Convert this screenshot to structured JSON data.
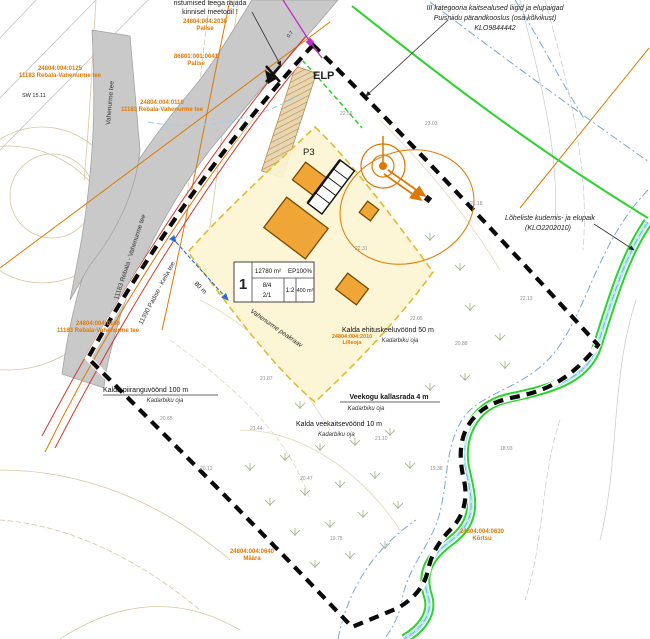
{
  "notes": {
    "crossing_line1": "ristumised teega rajada",
    "crossing_line2": "kinnisel meetodil !",
    "habitat_line1": "III kategooria kaitsealused liigid ja elupaigad",
    "habitat_line2": "Puisniidu pärandkooslus (osa kõlvikust)",
    "habitat_line3": "KLO9844442",
    "spawning_line1": "Lõheliste kudemis- ja elupaik",
    "spawning_line2": "(KLO2202010)"
  },
  "zones": {
    "piirang": {
      "label": "Kalda piiranguvöönd 100 m",
      "stream": "Kadarbiku oja"
    },
    "keeld": {
      "label": "Kalda ehituskeeluvöönd 50 m",
      "stream": "Kadarbiku oja"
    },
    "kallasrada": {
      "label": "Veekogu kallasrada 4 m",
      "stream": "Kadarbiku oja"
    },
    "veekaitse": {
      "label": "Kalda veekaitsevöönd 10 m",
      "stream": "Kadarbiku oja"
    }
  },
  "plot": {
    "number": "1",
    "area": "12780 m²",
    "coverage": "EP100%",
    "heights": "8/4",
    "floors": "2/1",
    "roof": "1:2",
    "building_area": "400 m²"
  },
  "labels": {
    "elp": "ELP",
    "parking": "P3",
    "ditch": "Vahenurme peakraav",
    "dim": "80 m",
    "benchmark": "SW 15.11",
    "grade": "0.7"
  },
  "roads": {
    "left_road": "11183 Rebala - Vahenurme tee",
    "arm_road": "Vahenurme tee",
    "main_road": "11390 Padise - Keila tee"
  },
  "cadastral": [
    {
      "code": "24804:004:2030",
      "name": "Palise"
    },
    {
      "code": "86801:001:0041",
      "name": "Palise"
    },
    {
      "code": "24804:004:0125",
      "name": "11183 Rebala-Vahenurme tee"
    },
    {
      "code": "24804:004:0110",
      "name": "11183 Rebala-Vahenurme tee"
    },
    {
      "code": "24804:004:0140",
      "name": "11183 Rebala-Vahenurme tee"
    },
    {
      "code": "24804:004:0640",
      "name": "Määra"
    },
    {
      "code": "24804:004:0630",
      "name": "Kõrtsu"
    },
    {
      "code": "24804:004:2010",
      "name": "Lilleoja"
    }
  ],
  "spots": [
    {
      "v": "22.56"
    },
    {
      "v": "23.03"
    },
    {
      "v": "21.18"
    },
    {
      "v": "22.13"
    },
    {
      "v": "20.88"
    },
    {
      "v": "21.10"
    },
    {
      "v": "20.47"
    },
    {
      "v": "21.44"
    },
    {
      "v": "20.12"
    },
    {
      "v": "19.75"
    },
    {
      "v": "19.38"
    },
    {
      "v": "18.93"
    },
    {
      "v": "21.87"
    },
    {
      "v": "22.31"
    },
    {
      "v": "22.05"
    },
    {
      "v": "20.65"
    }
  ],
  "colors": {
    "boundary": "#0a0a0a",
    "plot_fill": "#fcf4d2",
    "plot_border": "#e0bb30",
    "building": "#f0a637",
    "cadastral_orange": "#e07800",
    "protection_green": "#2bd42b",
    "water_blue": "#9cd0e8",
    "buffer_blue": "#7aa7d9",
    "road_gray": "#c9c9c9",
    "red_line": "#cf3a2e",
    "magenta": "#c32bc9"
  }
}
